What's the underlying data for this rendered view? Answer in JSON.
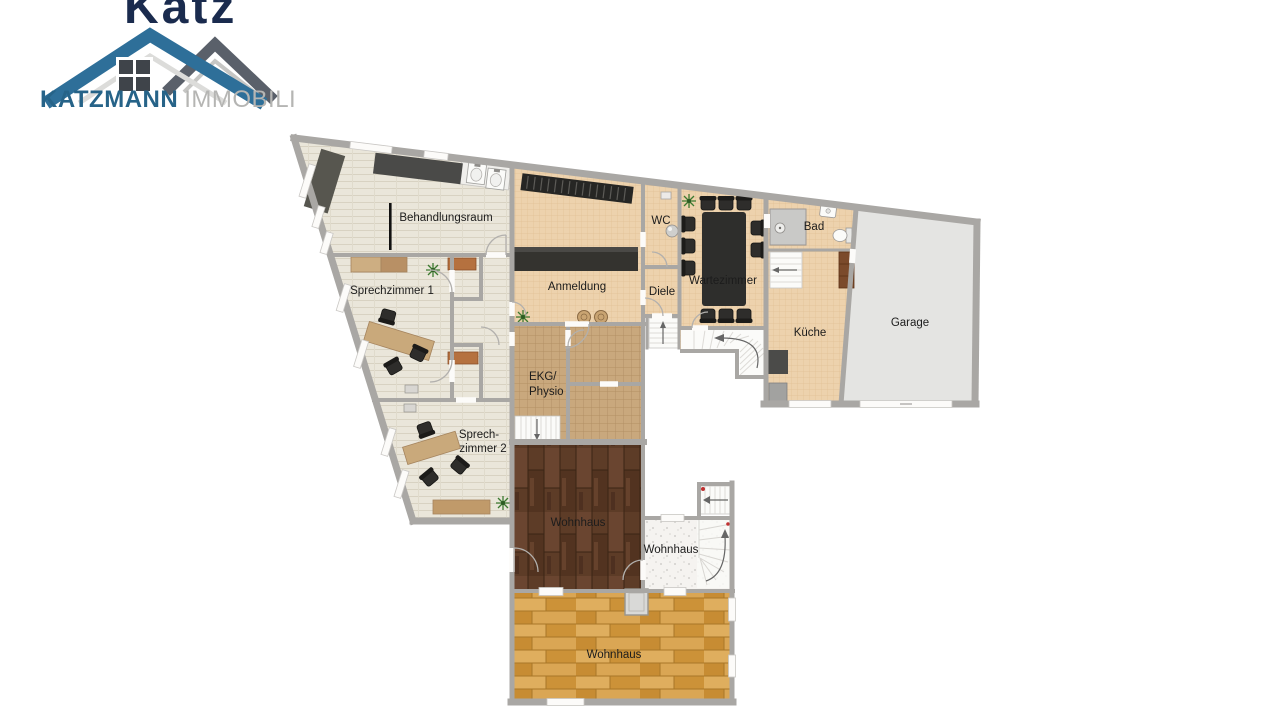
{
  "logo": {
    "watermark_text": "Katz",
    "brand_primary": "KATZMANN",
    "brand_secondary": "IMMOBILIEN",
    "colors": {
      "roof_blue": "#2e6f99",
      "roof_gray": "#5a606a",
      "roof_inner_light": "#d9d9d7",
      "window_dark": "#3f444a",
      "brand_blue": "#266388",
      "brand_gray": "#b5b5b3",
      "watermark_navy": "#1a2b4e"
    }
  },
  "floorplan": {
    "background": "#ffffff",
    "wall_color": "#a9a7a4",
    "floor_colors": {
      "practice_tile": "#eae6da",
      "hall_peach": "#edd2ad",
      "ekg_tan": "#c9a87d",
      "garage_gray": "#e4e4e2",
      "wood_dark": "#5d3c27",
      "wood_oak": "#d6a049",
      "stair_hall_speckle": "#f5f3f0"
    },
    "rooms": {
      "behandlungsraum": {
        "label": "Behandlungsraum"
      },
      "sprechzimmer_1": {
        "label": "Sprechzimmer 1"
      },
      "sprechzimmer_2": {
        "label_line_1": "Sprech-",
        "label_line_2": "zimmer 2"
      },
      "anmeldung": {
        "label": "Anmeldung"
      },
      "wc": {
        "label": "WC"
      },
      "diele": {
        "label": "Diele"
      },
      "wartezimmer": {
        "label": "Wartezimmer"
      },
      "bad": {
        "label": "Bad"
      },
      "kueche": {
        "label": "Küche"
      },
      "garage": {
        "label": "Garage"
      },
      "ekg_physio": {
        "label_line_1": "EKG/",
        "label_line_2": "Physio"
      },
      "wohnhaus_upper": {
        "label": "Wohnhaus"
      },
      "wohnhaus_stairhall": {
        "label": "Wohnhaus"
      },
      "wohnhaus_lower": {
        "label": "Wohnhaus"
      }
    }
  }
}
